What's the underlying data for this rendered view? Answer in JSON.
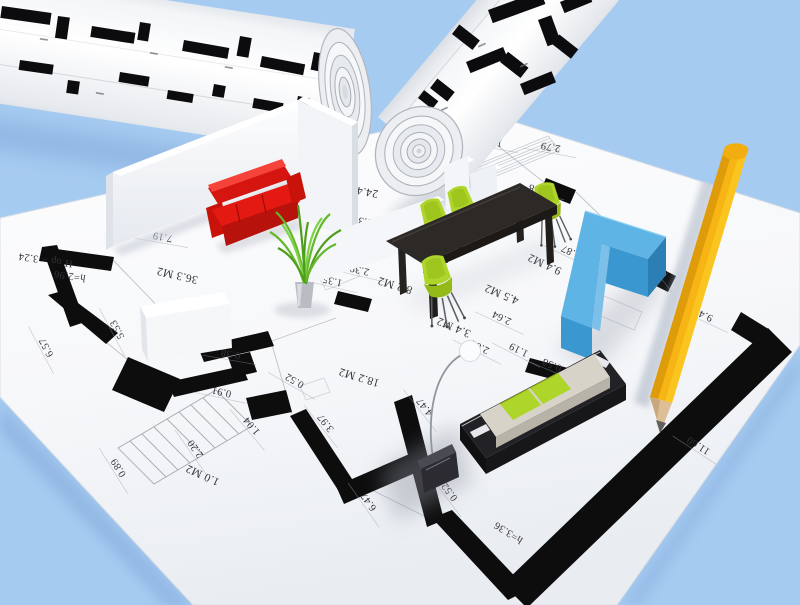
{
  "colors": {
    "background": "#a6cbf1",
    "paper": "#f7f8fa",
    "ink": "#0d0d0e",
    "label": "#34343a",
    "sofa_red": "#e41911",
    "sofa_red_dark": "#b8120c",
    "chair_lime": "#aed62a",
    "chair_lime_dark": "#93ba16",
    "table_dark": "#2d2926",
    "sofa_blue_top": "#5fb4e6",
    "sofa_blue_front": "#3b97d0",
    "sofa_blue_side": "#2b7fb4",
    "bench_dark": "#222226",
    "cushion_cream": "#d7d3c8",
    "pencil_yellow": "#f6b515",
    "pencil_wood": "#ddbf97",
    "plant_green": "#63b92a"
  },
  "plan": {
    "labels": [
      {
        "text": "H op = 3.24",
        "x": 46,
        "y": 257,
        "rot": 188,
        "kind": "height"
      },
      {
        "text": "h=2.96",
        "x": 70,
        "y": 273,
        "rot": 188,
        "kind": "height"
      },
      {
        "text": "7.19",
        "x": 163,
        "y": 234,
        "rot": 190,
        "kind": "dimension"
      },
      {
        "text": "36.3 M2",
        "x": 178,
        "y": 272,
        "rot": 193,
        "kind": "area"
      },
      {
        "text": "6.57",
        "x": 49,
        "y": 346,
        "rot": 242,
        "kind": "dimension"
      },
      {
        "text": "5.53",
        "x": 120,
        "y": 328,
        "rot": 242,
        "kind": "dimension"
      },
      {
        "text": "0.38",
        "x": 231,
        "y": 351,
        "rot": 190,
        "kind": "dimension"
      },
      {
        "text": "0.91",
        "x": 222,
        "y": 389,
        "rot": 192,
        "kind": "dimension"
      },
      {
        "text": "1.04",
        "x": 254,
        "y": 424,
        "rot": 230,
        "kind": "dimension"
      },
      {
        "text": "2.20",
        "x": 198,
        "y": 447,
        "rot": 235,
        "kind": "dimension"
      },
      {
        "text": "0.89",
        "x": 121,
        "y": 466,
        "rot": 238,
        "kind": "dimension"
      },
      {
        "text": "1.0 M2",
        "x": 204,
        "y": 472,
        "rot": 205,
        "kind": "area"
      },
      {
        "text": "0.52",
        "x": 296,
        "y": 378,
        "rot": 210,
        "kind": "dimension"
      },
      {
        "text": "18.2 M2",
        "x": 360,
        "y": 374,
        "rot": 197,
        "kind": "area"
      },
      {
        "text": "3.97",
        "x": 328,
        "y": 421,
        "rot": 232,
        "kind": "dimension"
      },
      {
        "text": "6.47",
        "x": 371,
        "y": 500,
        "rot": 235,
        "kind": "dimension"
      },
      {
        "text": "24.4 M2",
        "x": 358,
        "y": 187,
        "rot": 190,
        "kind": "area"
      },
      {
        "text": "0.38",
        "x": 363,
        "y": 218,
        "rot": 190,
        "kind": "dimension"
      },
      {
        "text": "2.39",
        "x": 360,
        "y": 267,
        "rot": 193,
        "kind": "dimension"
      },
      {
        "text": "1.35",
        "x": 333,
        "y": 278,
        "rot": 193,
        "kind": "dimension"
      },
      {
        "text": "8.2 M2",
        "x": 396,
        "y": 282,
        "rot": 197,
        "kind": "area"
      },
      {
        "text": "1.50",
        "x": 493,
        "y": 139,
        "rot": 190,
        "kind": "dimension"
      },
      {
        "text": "2.79",
        "x": 551,
        "y": 144,
        "rot": 190,
        "kind": "dimension"
      },
      {
        "text": "0.58",
        "x": 539,
        "y": 186,
        "rot": 190,
        "kind": "dimension"
      },
      {
        "text": "3.87",
        "x": 572,
        "y": 249,
        "rot": 205,
        "kind": "dimension"
      },
      {
        "text": "9.4 M2",
        "x": 546,
        "y": 261,
        "rot": 205,
        "kind": "area"
      },
      {
        "text": "4.5 M2",
        "x": 503,
        "y": 291,
        "rot": 203,
        "kind": "area"
      },
      {
        "text": "2.64",
        "x": 503,
        "y": 315,
        "rot": 205,
        "kind": "dimension"
      },
      {
        "text": "3.4 M2",
        "x": 455,
        "y": 324,
        "rot": 203,
        "kind": "area"
      },
      {
        "text": "2.64",
        "x": 481,
        "y": 344,
        "rot": 207,
        "kind": "dimension"
      },
      {
        "text": "1.19",
        "x": 520,
        "y": 347,
        "rot": 207,
        "kind": "dimension"
      },
      {
        "text": "0.58",
        "x": 553,
        "y": 362,
        "rot": 203,
        "kind": "dimension"
      },
      {
        "text": "4.47",
        "x": 427,
        "y": 405,
        "rot": 232,
        "kind": "dimension"
      },
      {
        "text": "0.52",
        "x": 452,
        "y": 490,
        "rot": 233,
        "kind": "dimension"
      },
      {
        "text": "h=3.36",
        "x": 510,
        "y": 530,
        "rot": 212,
        "kind": "height"
      },
      {
        "text": "11.60",
        "x": 700,
        "y": 443,
        "rot": 213,
        "kind": "dimension"
      },
      {
        "text": "9.4",
        "x": 707,
        "y": 313,
        "rot": 205,
        "kind": "dimension"
      },
      {
        "text": "6.49",
        "x": 663,
        "y": 266,
        "rot": 232,
        "kind": "dimension"
      }
    ]
  }
}
